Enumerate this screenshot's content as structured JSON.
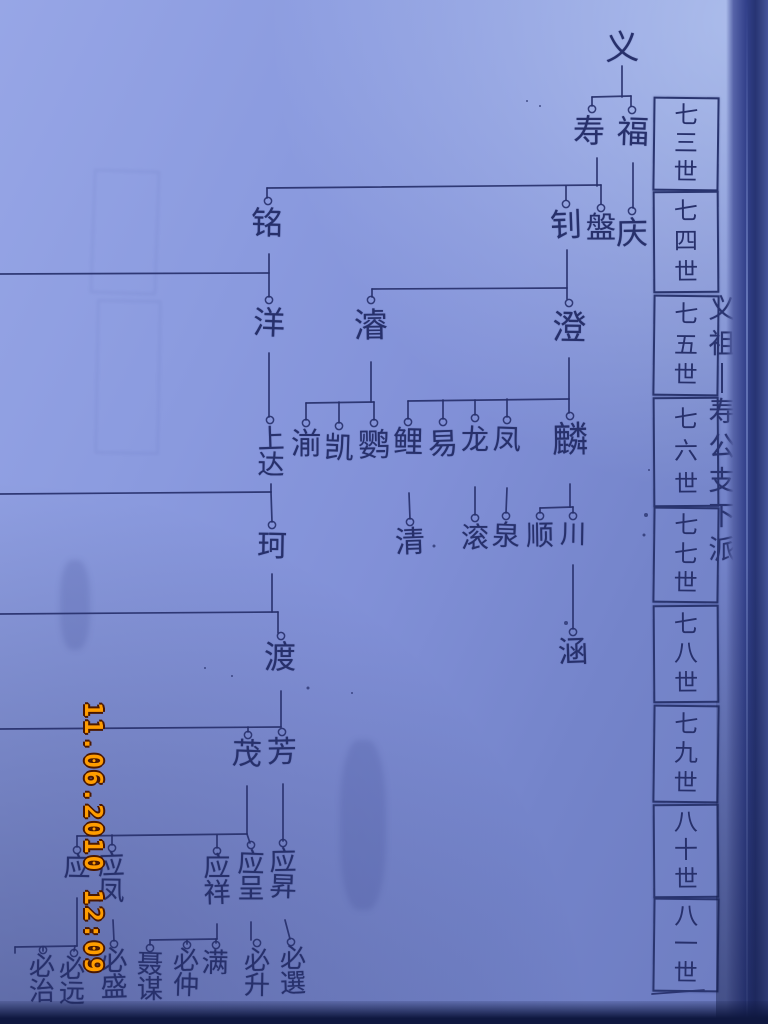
{
  "photo": {
    "description": "photograph of handwritten Chinese genealogy chart on blue paper",
    "paper_color": "#8190d7",
    "ink_color": "#27306b",
    "stamp_color": "#ff9d00"
  },
  "stamp": {
    "text": "11.06.2010 12:09"
  },
  "generation_column": {
    "boxes": [
      {
        "label": "七三世",
        "y": 97,
        "h": 90
      },
      {
        "label": "七四世",
        "y": 191,
        "h": 98
      },
      {
        "label": "七五世",
        "y": 295,
        "h": 97
      },
      {
        "label": "七六世",
        "y": 397,
        "h": 106
      },
      {
        "label": "七七世",
        "y": 507,
        "h": 92
      },
      {
        "label": "七八世",
        "y": 605,
        "h": 94
      },
      {
        "label": "七九世",
        "y": 705,
        "h": 94
      },
      {
        "label": "八十世",
        "y": 804,
        "h": 90
      },
      {
        "label": "八一世",
        "y": 898,
        "h": 90
      }
    ]
  },
  "side_note": {
    "text": "义祖丨寿公支下派"
  },
  "tree": {
    "nodes": [
      {
        "name": "义",
        "x": 622,
        "y": 32,
        "fs": 34,
        "c": null
      },
      {
        "name": "寿",
        "x": 589,
        "y": 116,
        "fs": 32,
        "c": [
          592,
          109
        ]
      },
      {
        "name": "福",
        "x": 633,
        "y": 117,
        "fs": 32,
        "c": [
          632,
          110
        ]
      },
      {
        "name": "庆",
        "x": 632,
        "y": 218,
        "fs": 32,
        "c": [
          632,
          211
        ]
      },
      {
        "name": "铭",
        "x": 267,
        "y": 208,
        "fs": 32,
        "c": [
          268,
          201
        ]
      },
      {
        "name": "钊",
        "x": 566,
        "y": 210,
        "fs": 32,
        "c": [
          566,
          204
        ]
      },
      {
        "name": "盤",
        "x": 601,
        "y": 214,
        "fs": 30,
        "c": [
          601,
          208
        ]
      },
      {
        "name": "洋",
        "x": 269,
        "y": 308,
        "fs": 32,
        "c": [
          269,
          300
        ]
      },
      {
        "name": "濬",
        "x": 371,
        "y": 310,
        "fs": 34,
        "c": [
          371,
          300
        ]
      },
      {
        "name": "澄",
        "x": 569,
        "y": 312,
        "fs": 34,
        "c": [
          569,
          303
        ]
      },
      {
        "name": "上达",
        "x": 271,
        "y": 426,
        "fs": 27,
        "c": [
          270,
          420
        ]
      },
      {
        "name": "湔",
        "x": 306,
        "y": 430,
        "fs": 30,
        "c": [
          306,
          423
        ]
      },
      {
        "name": "凯",
        "x": 339,
        "y": 434,
        "fs": 30,
        "c": [
          339,
          426
        ]
      },
      {
        "name": "鹦",
        "x": 374,
        "y": 430,
        "fs": 32,
        "c": [
          374,
          423
        ]
      },
      {
        "name": "鲤",
        "x": 408,
        "y": 428,
        "fs": 30,
        "c": [
          408,
          422
        ]
      },
      {
        "name": "易",
        "x": 443,
        "y": 430,
        "fs": 30,
        "c": [
          443,
          422
        ]
      },
      {
        "name": "龙",
        "x": 475,
        "y": 426,
        "fs": 28,
        "c": [
          475,
          418
        ]
      },
      {
        "name": "凤",
        "x": 507,
        "y": 426,
        "fs": 28,
        "c": [
          507,
          420
        ]
      },
      {
        "name": "麟",
        "x": 570,
        "y": 422,
        "fs": 36,
        "c": [
          570,
          416
        ]
      },
      {
        "name": "珂",
        "x": 272,
        "y": 532,
        "fs": 30,
        "c": [
          272,
          525
        ]
      },
      {
        "name": "清",
        "x": 410,
        "y": 528,
        "fs": 30,
        "c": [
          410,
          522
        ]
      },
      {
        "name": "滚",
        "x": 475,
        "y": 524,
        "fs": 28,
        "c": [
          475,
          518
        ]
      },
      {
        "name": "泉",
        "x": 506,
        "y": 522,
        "fs": 28,
        "c": [
          506,
          516
        ]
      },
      {
        "name": "顺",
        "x": 540,
        "y": 522,
        "fs": 28,
        "c": [
          540,
          516
        ]
      },
      {
        "name": "川",
        "x": 573,
        "y": 522,
        "fs": 26,
        "c": [
          573,
          516
        ]
      },
      {
        "name": "涵",
        "x": 573,
        "y": 638,
        "fs": 30,
        "c": [
          573,
          632
        ]
      },
      {
        "name": "渡",
        "x": 280,
        "y": 642,
        "fs": 32,
        "c": [
          281,
          636
        ]
      },
      {
        "name": "茂",
        "x": 247,
        "y": 740,
        "fs": 30,
        "c": [
          248,
          735
        ]
      },
      {
        "name": "芳",
        "x": 282,
        "y": 738,
        "fs": 30,
        "c": [
          282,
          732
        ]
      },
      {
        "name": "应",
        "x": 77,
        "y": 854,
        "fs": 27,
        "c": [
          77,
          850
        ]
      },
      {
        "name": "应凤",
        "x": 111,
        "y": 852,
        "fs": 27,
        "c": [
          112,
          848
        ]
      },
      {
        "name": "应祥",
        "x": 217,
        "y": 854,
        "fs": 27,
        "c": [
          217,
          851
        ]
      },
      {
        "name": "应呈",
        "x": 251,
        "y": 850,
        "fs": 27,
        "c": [
          251,
          845
        ]
      },
      {
        "name": "应昇",
        "x": 283,
        "y": 848,
        "fs": 27,
        "c": [
          283,
          843
        ]
      },
      {
        "name": "必治",
        "x": 42,
        "y": 954,
        "fs": 26,
        "c": [
          43,
          950
        ]
      },
      {
        "name": "必远",
        "x": 72,
        "y": 956,
        "fs": 26,
        "c": [
          74,
          953
        ]
      },
      {
        "name": "必盛",
        "x": 114,
        "y": 948,
        "fs": 27,
        "c": [
          114,
          944
        ]
      },
      {
        "name": "聂谋",
        "x": 150,
        "y": 952,
        "fs": 26,
        "c": [
          150,
          948
        ]
      },
      {
        "name": "必仲",
        "x": 186,
        "y": 948,
        "fs": 26,
        "c": [
          187,
          945
        ]
      },
      {
        "name": "满",
        "x": 215,
        "y": 950,
        "fs": 27,
        "c": [
          216,
          945
        ]
      },
      {
        "name": "必升",
        "x": 257,
        "y": 948,
        "fs": 26,
        "c": [
          257,
          943
        ]
      },
      {
        "name": "必選",
        "x": 293,
        "y": 946,
        "fs": 26,
        "c": [
          291,
          942
        ]
      }
    ],
    "edges": [
      [
        [
          622,
          66
        ],
        [
          622,
          97
        ]
      ],
      [
        [
          592,
          97
        ],
        [
          631,
          96
        ]
      ],
      [
        [
          592,
          97
        ],
        [
          592,
          106
        ]
      ],
      [
        [
          631,
          96
        ],
        [
          631,
          106
        ]
      ],
      [
        [
          597,
          158
        ],
        [
          597,
          186
        ]
      ],
      [
        [
          267,
          188
        ],
        [
          601,
          185
        ]
      ],
      [
        [
          267,
          188
        ],
        [
          267,
          198
        ]
      ],
      [
        [
          566,
          186
        ],
        [
          566,
          200
        ]
      ],
      [
        [
          601,
          185
        ],
        [
          601,
          204
        ]
      ],
      [
        [
          633,
          163
        ],
        [
          633,
          208
        ]
      ],
      [
        [
          269,
          254
        ],
        [
          269,
          297
        ]
      ],
      [
        [
          0,
          274
        ],
        [
          269,
          273
        ]
      ],
      [
        [
          567,
          250
        ],
        [
          567,
          299
        ]
      ],
      [
        [
          372,
          289
        ],
        [
          567,
          288
        ]
      ],
      [
        [
          372,
          289
        ],
        [
          372,
          297
        ]
      ],
      [
        [
          269,
          353
        ],
        [
          269,
          417
        ]
      ],
      [
        [
          371,
          362
        ],
        [
          371,
          402
        ]
      ],
      [
        [
          306,
          403
        ],
        [
          374,
          402
        ]
      ],
      [
        [
          306,
          403
        ],
        [
          306,
          420
        ]
      ],
      [
        [
          339,
          402
        ],
        [
          339,
          423
        ]
      ],
      [
        [
          374,
          402
        ],
        [
          374,
          420
        ]
      ],
      [
        [
          569,
          358
        ],
        [
          569,
          399
        ]
      ],
      [
        [
          408,
          401
        ],
        [
          569,
          399
        ]
      ],
      [
        [
          408,
          401
        ],
        [
          408,
          419
        ]
      ],
      [
        [
          443,
          400
        ],
        [
          443,
          419
        ]
      ],
      [
        [
          475,
          400
        ],
        [
          475,
          415
        ]
      ],
      [
        [
          507,
          399
        ],
        [
          507,
          417
        ]
      ],
      [
        [
          569,
          399
        ],
        [
          569,
          413
        ]
      ],
      [
        [
          271,
          484
        ],
        [
          271,
          492
        ]
      ],
      [
        [
          0,
          494
        ],
        [
          271,
          492
        ]
      ],
      [
        [
          271,
          492
        ],
        [
          272,
          522
        ]
      ],
      [
        [
          570,
          484
        ],
        [
          570,
          507
        ]
      ],
      [
        [
          540,
          508
        ],
        [
          573,
          507
        ]
      ],
      [
        [
          540,
          508
        ],
        [
          540,
          513
        ]
      ],
      [
        [
          573,
          507
        ],
        [
          573,
          513
        ]
      ],
      [
        [
          409,
          493
        ],
        [
          410,
          519
        ]
      ],
      [
        [
          475,
          487
        ],
        [
          475,
          515
        ]
      ],
      [
        [
          507,
          488
        ],
        [
          506,
          513
        ]
      ],
      [
        [
          573,
          565
        ],
        [
          573,
          629
        ]
      ],
      [
        [
          272,
          574
        ],
        [
          272,
          612
        ]
      ],
      [
        [
          0,
          614
        ],
        [
          278,
          612
        ]
      ],
      [
        [
          278,
          612
        ],
        [
          278,
          633
        ]
      ],
      [
        [
          281,
          691
        ],
        [
          281,
          727
        ]
      ],
      [
        [
          0,
          729
        ],
        [
          281,
          727
        ]
      ],
      [
        [
          248,
          727
        ],
        [
          248,
          732
        ]
      ],
      [
        [
          247,
          786
        ],
        [
          247,
          834
        ]
      ],
      [
        [
          77,
          836
        ],
        [
          247,
          834
        ]
      ],
      [
        [
          77,
          836
        ],
        [
          77,
          847
        ]
      ],
      [
        [
          112,
          835
        ],
        [
          112,
          845
        ]
      ],
      [
        [
          217,
          835
        ],
        [
          217,
          848
        ]
      ],
      [
        [
          247,
          834
        ],
        [
          250,
          843
        ]
      ],
      [
        [
          283,
          784
        ],
        [
          283,
          841
        ]
      ],
      [
        [
          113,
          920
        ],
        [
          114,
          941
        ]
      ],
      [
        [
          217,
          924
        ],
        [
          217,
          939
        ]
      ],
      [
        [
          150,
          940
        ],
        [
          217,
          939
        ]
      ],
      [
        [
          150,
          940
        ],
        [
          150,
          945
        ]
      ],
      [
        [
          187,
          940
        ],
        [
          187,
          944
        ]
      ],
      [
        [
          216,
          939
        ],
        [
          216,
          943
        ]
      ],
      [
        [
          251,
          922
        ],
        [
          251,
          940
        ]
      ],
      [
        [
          285,
          920
        ],
        [
          290,
          939
        ]
      ],
      [
        [
          77,
          898
        ],
        [
          77,
          946
        ]
      ],
      [
        [
          15,
          947
        ],
        [
          77,
          946
        ]
      ],
      [
        [
          15,
          947
        ],
        [
          15,
          953
        ]
      ],
      [
        [
          43,
          947
        ],
        [
          43,
          951
        ]
      ],
      [
        [
          75,
          946
        ],
        [
          74,
          951
        ]
      ],
      [
        [
          652,
          994
        ],
        [
          704,
          990
        ]
      ]
    ],
    "specks": [
      [
        566,
        623,
        4
      ],
      [
        308,
        688,
        3
      ],
      [
        434,
        546,
        3
      ],
      [
        205,
        668,
        2
      ],
      [
        232,
        676,
        2
      ],
      [
        646,
        515,
        4
      ],
      [
        644,
        535,
        3
      ],
      [
        649,
        470,
        2
      ],
      [
        352,
        693,
        2
      ],
      [
        527,
        101,
        2
      ],
      [
        540,
        106,
        2
      ]
    ]
  }
}
